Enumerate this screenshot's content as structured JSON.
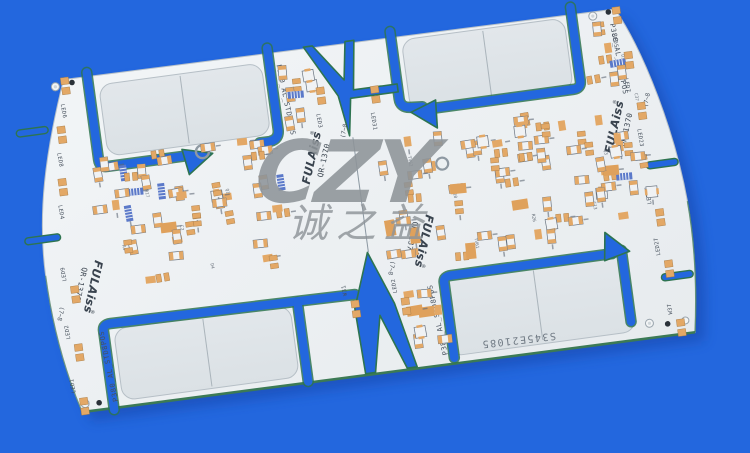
{
  "image_type": "product-photo of an aluminum LED PCB panel on a blue backdrop",
  "background_color": "#2367DE",
  "watermark": {
    "main": "CZY",
    "sub": "诚之益"
  },
  "pcb": {
    "panel_code": "P380_AL_STD8POS",
    "serial_number": "S345E21085",
    "logo": {
      "brand": "FULAiss",
      "registered": "®",
      "model": "QR-1370",
      "rev_mark": "(7~8"
    },
    "led_labels_left": [
      "LED6",
      "LED8",
      "LED4",
      "LED9",
      "LED2",
      "LED1"
    ],
    "led_labels_right": [
      "LED5",
      "LED7",
      "LED23",
      "LED25",
      "LED27",
      "W37"
    ],
    "led_labels_inner": [
      "LED3",
      "LED31",
      "LED2",
      "W31"
    ],
    "ref_labels": [
      "R17",
      "C2",
      "Q1",
      "R9",
      "R4",
      "D4",
      "TV62",
      "R10",
      "D37",
      "C37",
      "R26",
      "TV61",
      "Q3",
      "C13"
    ],
    "colors": {
      "board": "#EDF0F3",
      "panel_area": "#DFE5E9",
      "pad": "#E3A866",
      "component_body": "#F0F2F4",
      "blue_part": "#5B79C9",
      "slot_edge": "#2E7450",
      "silkscreen": "#46505C",
      "watermark": "#8E9499"
    }
  }
}
